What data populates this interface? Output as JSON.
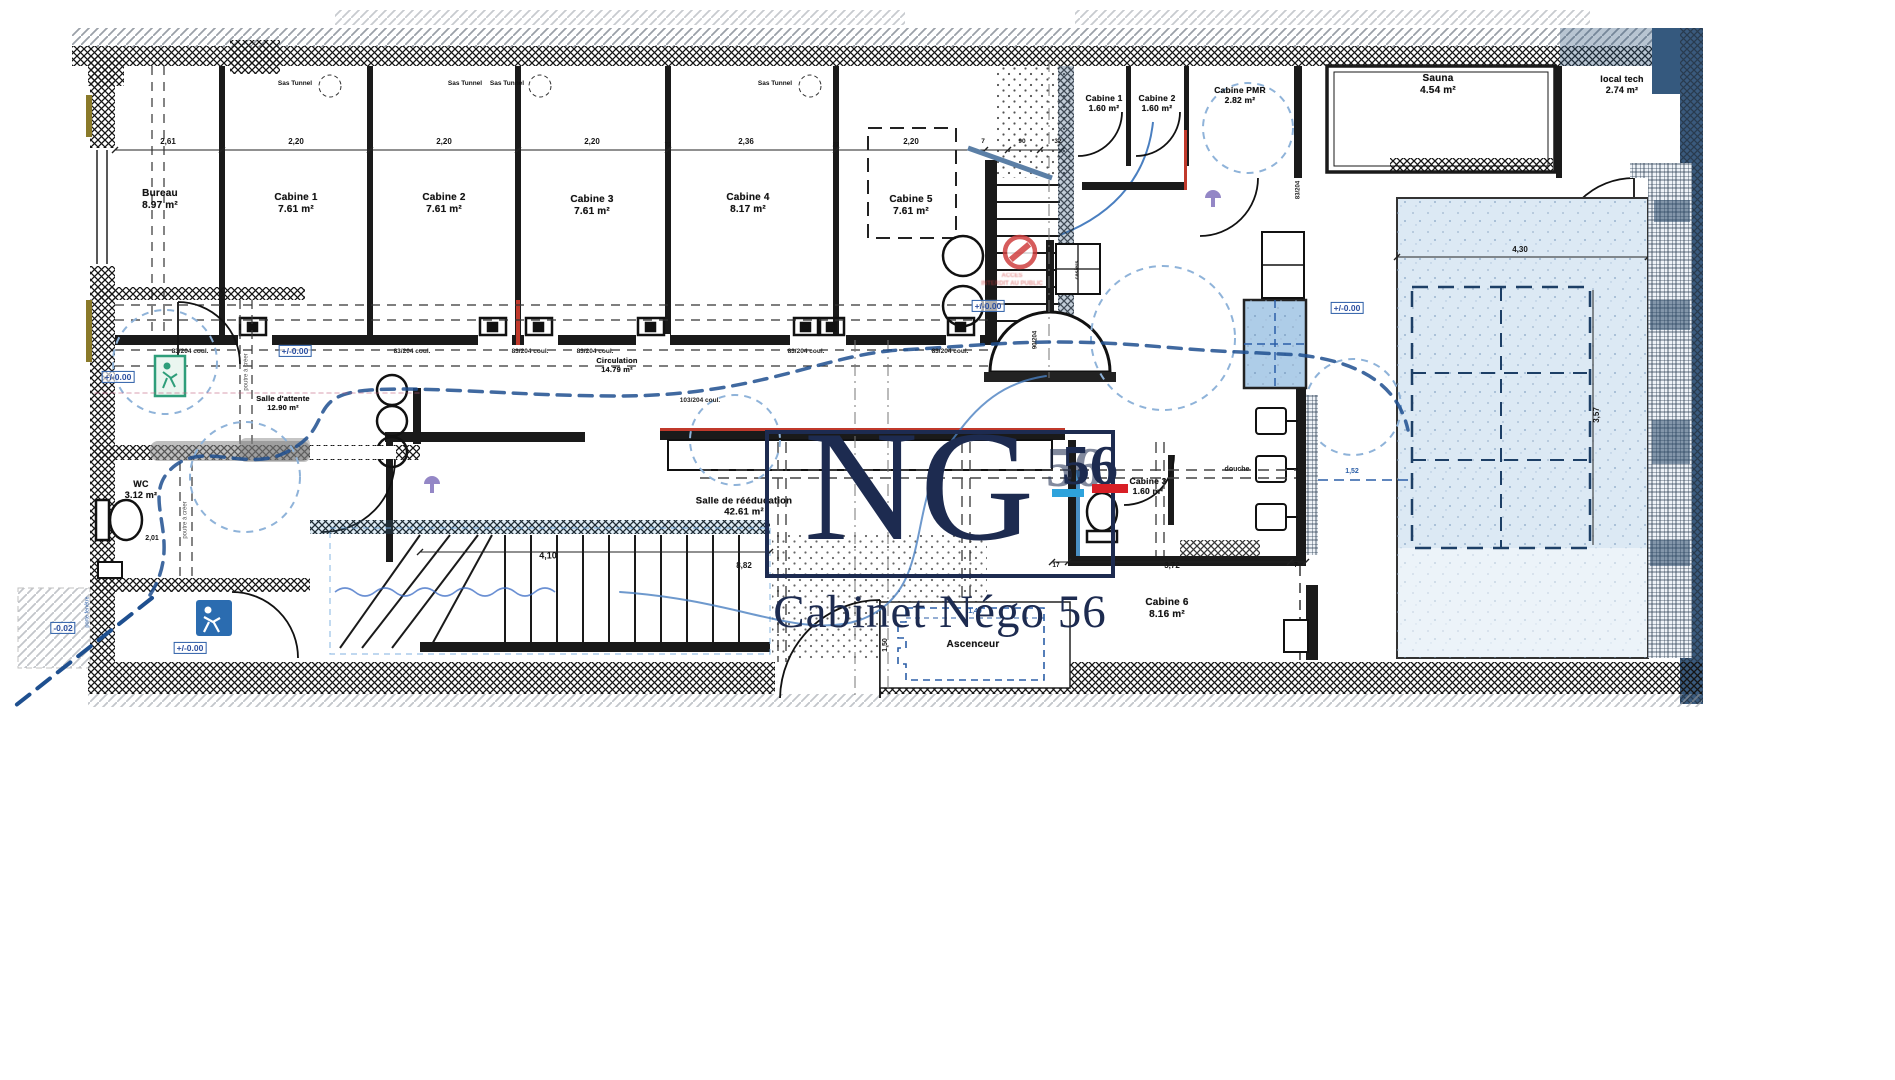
{
  "logo": {
    "monogram": "NG",
    "number": "56",
    "caption": "Cabinet Négo 56",
    "navy": "#1d2b50",
    "cyan": "#2ea3dc",
    "red": "#d81f26"
  },
  "stamp": {
    "line1": "ACCES",
    "line2": "INTERDIT AU PUBLIC",
    "x": 1012,
    "y": 281
  },
  "sas_label": "Sas Tunnel",
  "plan_labels": {
    "rooms": [
      {
        "label": "Bureau",
        "area": "8.97 m²",
        "x": 160,
        "y": 200
      },
      {
        "label": "Cabine 1",
        "area": "7.61 m²",
        "x": 296,
        "y": 204
      },
      {
        "label": "Cabine 2",
        "area": "7.61 m²",
        "x": 444,
        "y": 204
      },
      {
        "label": "Cabine 3",
        "area": "7.61 m²",
        "x": 592,
        "y": 206
      },
      {
        "label": "Cabine 4",
        "area": "8.17 m²",
        "x": 748,
        "y": 204
      },
      {
        "label": "Cabine 5",
        "area": "7.61 m²",
        "x": 911,
        "y": 206
      },
      {
        "label": "Cabine 1",
        "area": "1.60 m²",
        "x": 1104,
        "y": 103,
        "fs": 8.5
      },
      {
        "label": "Cabine 2",
        "area": "1.60 m²",
        "x": 1157,
        "y": 103,
        "fs": 8.5
      },
      {
        "label": "Cabine PMR",
        "area": "2.82 m²",
        "x": 1240,
        "y": 95,
        "fs": 8.5
      },
      {
        "label": "Sauna",
        "area": "4.54 m²",
        "x": 1438,
        "y": 85
      },
      {
        "label": "local tech",
        "area": "2.74 m²",
        "x": 1622,
        "y": 85,
        "fs": 9
      },
      {
        "label": "Salle d'attente",
        "area": "12.90 m²",
        "x": 283,
        "y": 403,
        "fs": 7.5
      },
      {
        "label": "WC",
        "area": "3.12 m²",
        "x": 141,
        "y": 490,
        "fs": 9
      },
      {
        "label": "Circulation",
        "area": "14.79 m²",
        "x": 617,
        "y": 365,
        "fs": 7.5
      },
      {
        "label": "Salle de rééducation",
        "area": "42.61 m²",
        "x": 744,
        "y": 507,
        "fs": 9.5
      },
      {
        "label": "Cabine 3",
        "area": "1.60 m²",
        "x": 1148,
        "y": 486,
        "fs": 8.5
      },
      {
        "label": "Cabine 6",
        "area": "8.16 m²",
        "x": 1167,
        "y": 609
      },
      {
        "label": "Ascenceur",
        "area": "",
        "x": 973,
        "y": 645,
        "fs": 10
      }
    ],
    "dims": [
      {
        "v": "2,61",
        "x": 168,
        "y": 142
      },
      {
        "v": "2,20",
        "x": 296,
        "y": 142
      },
      {
        "v": "2,20",
        "x": 444,
        "y": 142
      },
      {
        "v": "2,20",
        "x": 592,
        "y": 142
      },
      {
        "v": "2,36",
        "x": 746,
        "y": 142
      },
      {
        "v": "2,20",
        "x": 911,
        "y": 142
      },
      {
        "v": "72",
        "x": 668,
        "y": 146,
        "fs": 6
      },
      {
        "v": "22",
        "x": 836,
        "y": 146,
        "fs": 6
      },
      {
        "v": "7",
        "x": 983,
        "y": 142,
        "fs": 6.5
      },
      {
        "v": "90",
        "x": 1022,
        "y": 142,
        "fs": 6.5
      },
      {
        "v": "32",
        "x": 1058,
        "y": 142,
        "fs": 6.5
      },
      {
        "v": "4,10",
        "x": 548,
        "y": 556,
        "fs": 9
      },
      {
        "v": "2,01",
        "x": 152,
        "y": 539,
        "fs": 7
      },
      {
        "v": "1,40",
        "x": 975,
        "y": 612,
        "fs": 7,
        "color": "#2b5ea7"
      },
      {
        "v": "1,50",
        "x": 886,
        "y": 645,
        "rot": -90,
        "fs": 7
      },
      {
        "v": "8,82",
        "x": 744,
        "y": 566
      },
      {
        "v": "3,72",
        "x": 1172,
        "y": 566
      },
      {
        "v": "7",
        "x": 1296,
        "y": 566,
        "fs": 7
      },
      {
        "v": "17",
        "x": 1056,
        "y": 566,
        "fs": 6.5
      },
      {
        "v": "4,30",
        "x": 1520,
        "y": 250
      },
      {
        "v": "3,57",
        "x": 1597,
        "y": 415,
        "rot": -90
      },
      {
        "v": "1,52",
        "x": 1352,
        "y": 472,
        "fs": 7,
        "color": "#2b5ea7"
      }
    ],
    "levels": [
      {
        "v": "+/-0.00",
        "x": 295,
        "y": 351,
        "variant": "box"
      },
      {
        "v": "+/-0.00",
        "x": 118,
        "y": 377,
        "variant": "faint"
      },
      {
        "v": "+/-0.00",
        "x": 988,
        "y": 306,
        "variant": "box"
      },
      {
        "v": "+/-0.00",
        "x": 190,
        "y": 648,
        "variant": "box"
      },
      {
        "v": "+/-0.00",
        "x": 1347,
        "y": 308,
        "variant": "box"
      },
      {
        "v": "-0.02",
        "x": 63,
        "y": 628,
        "variant": "box"
      }
    ],
    "small": [
      {
        "v": "83/204 coul.",
        "x": 190,
        "y": 352
      },
      {
        "v": "83/204 coul.",
        "x": 412,
        "y": 352
      },
      {
        "v": "83/204 coul.",
        "x": 530,
        "y": 352
      },
      {
        "v": "83/204 coul.",
        "x": 595,
        "y": 352
      },
      {
        "v": "83/204 coul.",
        "x": 806,
        "y": 352
      },
      {
        "v": "83/204 coul.",
        "x": 950,
        "y": 352
      },
      {
        "v": "103/204 coul.",
        "x": 700,
        "y": 401
      },
      {
        "v": "83/204",
        "x": 1299,
        "y": 190,
        "rot": -90,
        "fs": 6
      },
      {
        "v": "90/204",
        "x": 1036,
        "y": 340,
        "rot": -90,
        "fs": 6
      },
      {
        "v": "casiers",
        "x": 1078,
        "y": 270,
        "rot": -90,
        "fs": 5.5
      },
      {
        "v": "douche",
        "x": 1237,
        "y": 470,
        "fs": 7
      }
    ],
    "sas": [
      {
        "v": "Sas Tunnel",
        "x": 295,
        "y": 84
      },
      {
        "v": "Sas Tunnel",
        "x": 465,
        "y": 84
      },
      {
        "v": "Sas Tunnel",
        "x": 507,
        "y": 84
      },
      {
        "v": "Sas Tunnel",
        "x": 775,
        "y": 84
      }
    ],
    "notes": [
      {
        "v": "poutre à créer",
        "x": 247,
        "y": 372,
        "rot": -90
      },
      {
        "v": "poutre à créer",
        "x": 186,
        "y": 520,
        "rot": -90
      },
      {
        "v": "porte fenêtre",
        "x": 88,
        "y": 612,
        "rot": -90,
        "fs": 5.5,
        "color": "#2b5ea7"
      }
    ]
  }
}
